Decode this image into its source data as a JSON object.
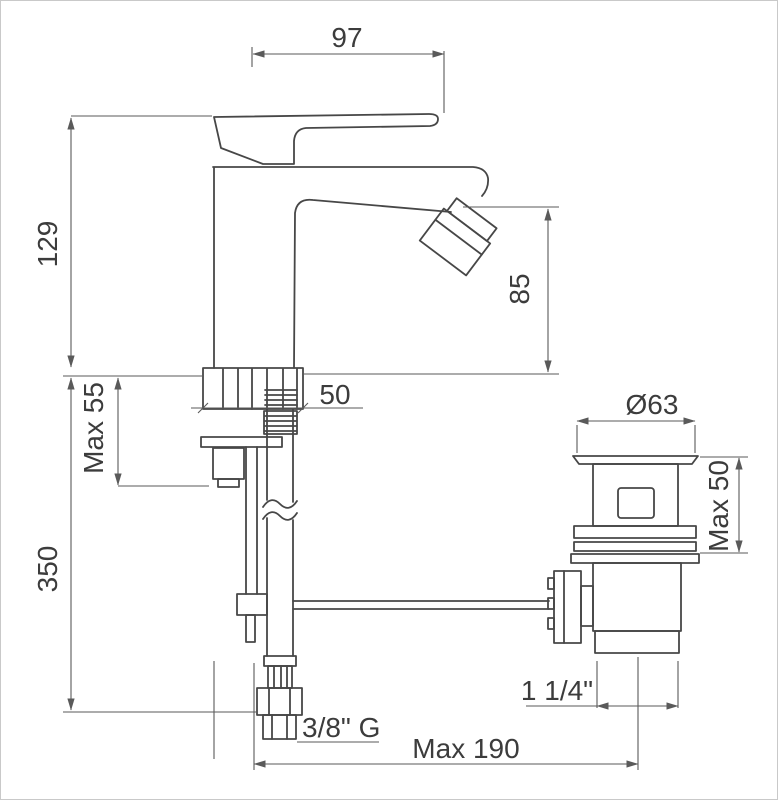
{
  "drawing": {
    "dims": {
      "spout_reach": "97",
      "height_above_deck": "129",
      "spout_height": "85",
      "max_deck_thickness": "Max 55",
      "base_width": "50",
      "supply_length": "350",
      "waste_flange_diameter": "Ø63",
      "waste_max_deck_thickness": "Max 50",
      "waste_thread_size": "1 1/4\"",
      "supply_thread_size": "3/8\" G",
      "max_distance": "Max 190"
    },
    "colors": {
      "line": "#474747",
      "dim": "#5a5a5a",
      "text": "#3c3c3c",
      "background": "#ffffff",
      "border": "#c9c9c9"
    }
  }
}
